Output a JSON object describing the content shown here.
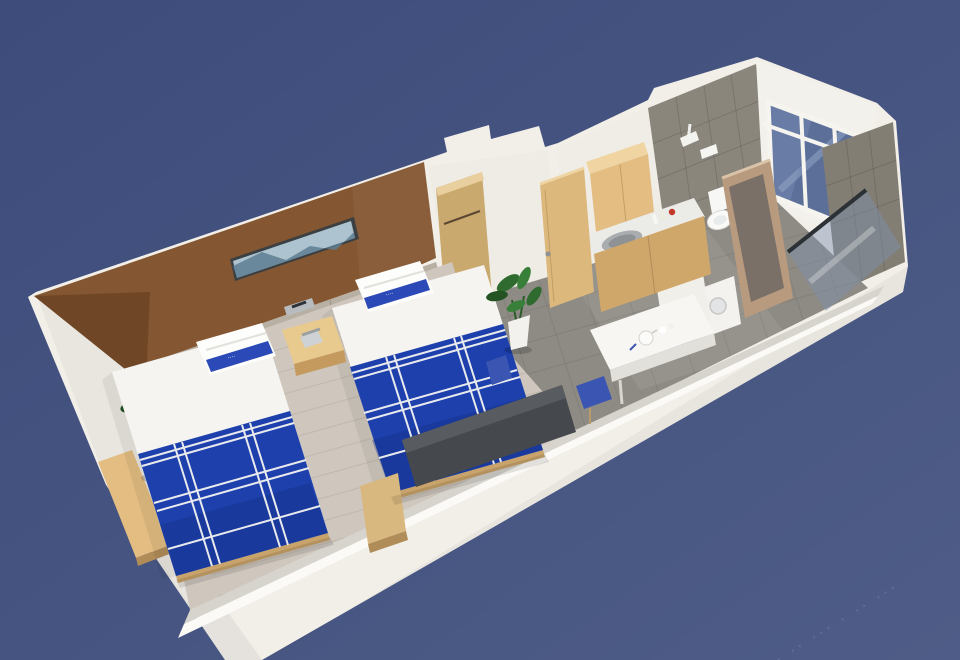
{
  "scene": {
    "type": "3d-room-cutaway-render",
    "room_label": "twin-bed hotel room with kitchenette and bathroom, isometric cutaway",
    "watermark_text": "· ·· ··· · ·· ···",
    "bed_runner_text": "····",
    "colors": {
      "bg": "#3d4c7b",
      "bg_light": "#50608e",
      "wall_white": "#f2efe9",
      "wall_inner": "#e9e6df",
      "wall_face_gray": "#d6d4cd",
      "accent_wall": "#845631",
      "accent_wall_dark": "#5f3c1e",
      "headboard": "#b7b0a3",
      "artwork_sky": "#adc3cf",
      "artwork_mountain": "#5d7e92",
      "sheet_white": "#f5f4f1",
      "bed_blue": "#1d40ac",
      "bed_blue_dark": "#14307f",
      "runner_blue": "#2b49b7",
      "wood_floor": "#ccc4ba",
      "tile_floor": "#8e8b84",
      "wood_light": "#e3bd82",
      "wood_mid": "#d0a76a",
      "wood_dark": "#b08c58",
      "tile_wall": "#8b867c",
      "tile_wall_dark": "#837e74",
      "glass_blue": "#5c6f99",
      "glass_pane": "#6d80a8",
      "door_frame_wood": "#b89a7e",
      "tv_dark": "#45484c",
      "chair_blue": "#3b55b2",
      "plant_green": "#2f6b2e",
      "plant_green_dark": "#235323",
      "counter_white": "#ebebe7",
      "sink_steel": "#a9adaf",
      "appliance_white": "#f3f2ef",
      "toilet_white": "#f7f7f5"
    },
    "objects": [
      {
        "name": "accent-wall",
        "desc": "brown feature wall behind beds"
      },
      {
        "name": "wall-artwork",
        "desc": "panoramic landscape painting"
      },
      {
        "name": "bed-1",
        "desc": "twin bed, white linen, blue runner quilt"
      },
      {
        "name": "bed-2",
        "desc": "twin bed, white linen, blue runner quilt"
      },
      {
        "name": "nightstand",
        "desc": "wood nightstand with telephone"
      },
      {
        "name": "bedside-control-panel",
        "desc": "panel on headboard"
      },
      {
        "name": "corner-plant",
        "desc": "potted plant in bedroom corner"
      },
      {
        "name": "entry-plant",
        "desc": "potted plant by entry door"
      },
      {
        "name": "wardrobe-niche",
        "desc": "open wardrobe with rail"
      },
      {
        "name": "entry-door",
        "desc": "light wood entry door"
      },
      {
        "name": "kitchen-upper-cabinet",
        "desc": "oak wall cabinet"
      },
      {
        "name": "kitchen-counter",
        "desc": "counter with stainless sink"
      },
      {
        "name": "kitchen-lower-cabinet",
        "desc": "oak base cabinet"
      },
      {
        "name": "toilet",
        "desc": "toilet in bathroom"
      },
      {
        "name": "shower-head",
        "desc": "shower fitting on tiled wall"
      },
      {
        "name": "bathroom-door",
        "desc": "wood-framed glass door"
      },
      {
        "name": "shower-glass",
        "desc": "leaning glass screen"
      },
      {
        "name": "window",
        "desc": "end-wall window with white mullions"
      },
      {
        "name": "washing-machine",
        "desc": "white appliance"
      },
      {
        "name": "dining-desk",
        "desc": "white desk with kettle and cups"
      },
      {
        "name": "stools",
        "desc": "blue stools"
      },
      {
        "name": "tv-panel",
        "desc": "flat TV on front wall"
      },
      {
        "name": "side-bench",
        "desc": "wood bench by TV"
      },
      {
        "name": "wall-desk",
        "desc": "wood desk along left wall"
      }
    ]
  }
}
